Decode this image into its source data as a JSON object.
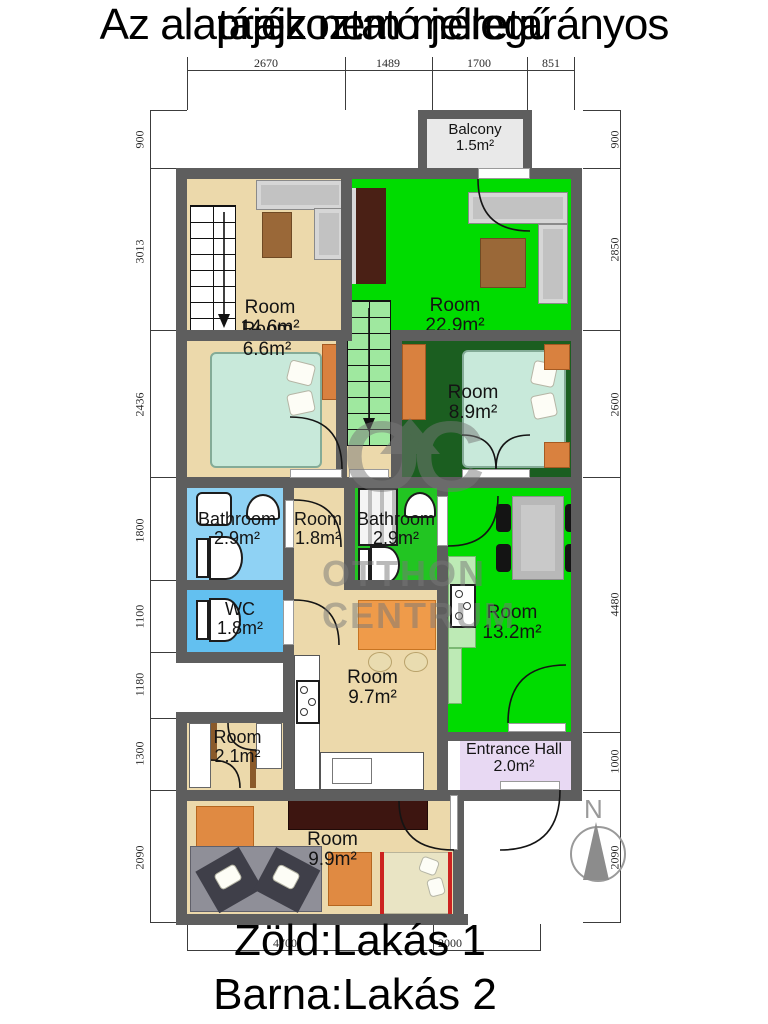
{
  "title": {
    "line1": "Az alaprajz nem méretarányos",
    "line2": "tájékoztató jellegű"
  },
  "legend": {
    "line1": "Zöld:Lakás 1",
    "line2": "Barna:Lakás 2"
  },
  "watermark": {
    "logo": "OC",
    "line1": "OTTHON",
    "line2": "CENTRUM"
  },
  "compass": {
    "north": "N"
  },
  "rooms": {
    "balcony": {
      "name": "Balcony",
      "area": "1.5m²"
    },
    "living1": {
      "name": "Room",
      "area": "14.6m²"
    },
    "living2": {
      "name": "Room",
      "area": "22.9m²"
    },
    "bedroom_left": {
      "name": "Room",
      "area": "6.6m²"
    },
    "bedroom_right": {
      "name": "Room",
      "area": "8.9m²"
    },
    "bathroom_left": {
      "name": "Bathroom",
      "area": "2.9m²"
    },
    "hall_small": {
      "name": "Room",
      "area": "1.8m²"
    },
    "bathroom_right": {
      "name": "Bathroom",
      "area": "2.9m²"
    },
    "dining": {
      "name": "Room",
      "area": "13.2m²"
    },
    "wc": {
      "name": "WC",
      "area": "1.8m²"
    },
    "kitchen": {
      "name": "Room",
      "area": "9.7m²"
    },
    "closet": {
      "name": "Room",
      "area": "2.1m²"
    },
    "entrance": {
      "name": "Entrance Hall",
      "area": "2.0m²"
    },
    "living_bottom": {
      "name": "Room",
      "area": "9.9m²"
    }
  },
  "dimensions": {
    "top": [
      "2670",
      "1489",
      "1700",
      "851"
    ],
    "bottom": [
      "4700",
      "2000"
    ],
    "left": [
      "900",
      "3013",
      "2436",
      "1800",
      "1100",
      "1180",
      "1300",
      "2090"
    ],
    "right": [
      "900",
      "2850",
      "2600",
      "4480",
      "1000",
      "2090"
    ]
  },
  "colors": {
    "green": "#00dc00",
    "tan": "#ecd9ab",
    "dark_green": "#1b5e20",
    "stairs_green": "#9fe89f",
    "bathroom_blue": "#8fd2f4",
    "wc_blue": "#63c0f0",
    "lavender": "#e8d9f3",
    "wall_gray": "#5e5e5e",
    "balcony_gray": "#e9e9e9",
    "orange": "#d9813f",
    "mint_bed": "#c8e9da"
  }
}
